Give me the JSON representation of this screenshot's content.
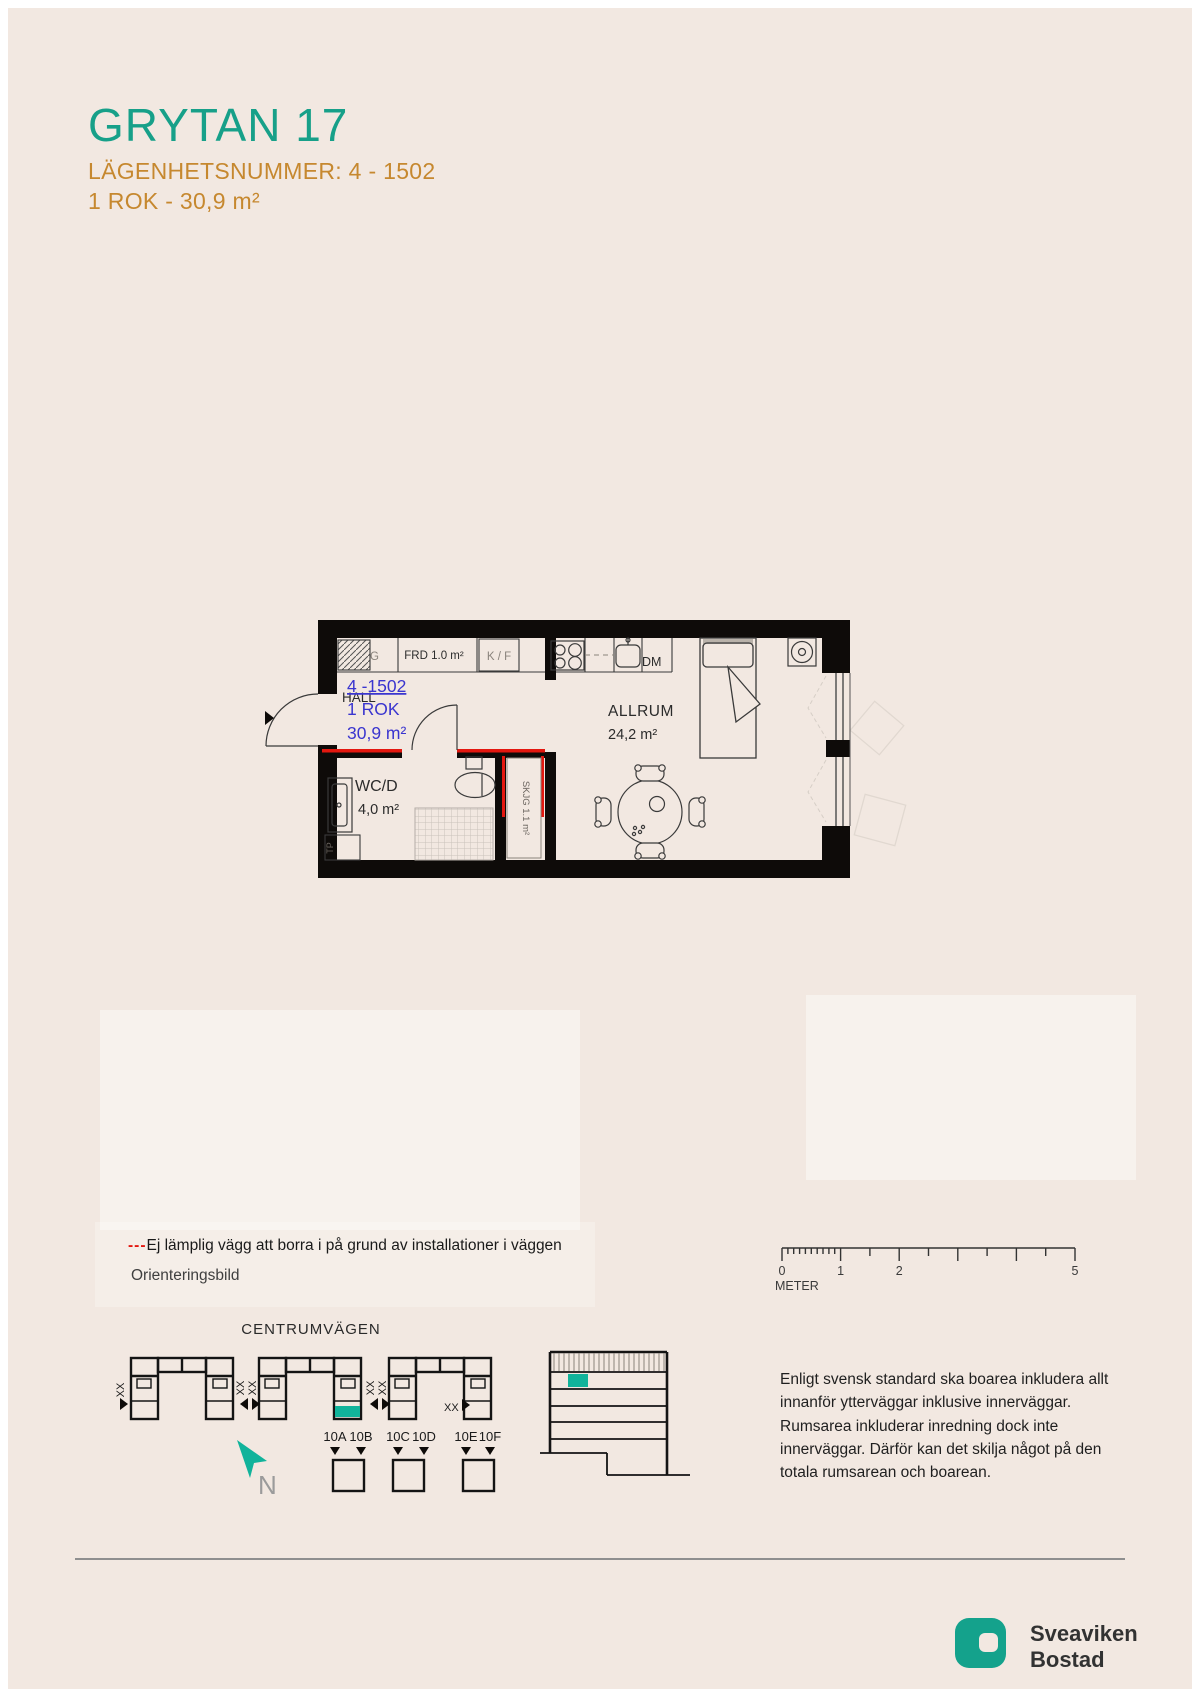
{
  "header": {
    "title": "GRYTAN 17",
    "apartment_number_line": "LÄGENHETSNUMMER: 4 - 1502",
    "size_line": "1 ROK - 30,9 m²"
  },
  "floorplan": {
    "unit_number": "4 -1502",
    "unit_type": "1 ROK",
    "unit_area": "30,9 m²",
    "hall_label": "HALL",
    "allrum_label": "ALLRUM",
    "allrum_area": "24,2 m²",
    "wcd_label": "WC/D",
    "wcd_area": "4,0 m²",
    "frd_label": "FRD 1.0 m²",
    "kf_label": "K / F",
    "dm_label": "DM",
    "g_label": "G",
    "tp_label": "TP",
    "skjg_label": "SKJG 1.1 m²"
  },
  "legend": {
    "no_drill_dashes": "---",
    "no_drill_text": "Ej lämplig vägg att borra i på grund av installationer i väggen",
    "orientation_label": "Orienteringsbild"
  },
  "scale_bar": {
    "labels": [
      "0",
      "1",
      "2",
      "5"
    ],
    "unit_label": "METER"
  },
  "site_plan": {
    "street_name": "CENTRUMVÄGEN",
    "xx_label": "XX",
    "north_label": "N",
    "entrance_labels": [
      "10A",
      "10B",
      "10C",
      "10D",
      "10E",
      "10F"
    ]
  },
  "info": {
    "text": "Enligt svensk standard ska boarea inkludera allt innanför ytterväggar inklusive innerväggar. Rumsarea inkluderar inredning dock inte innerväggar. Därför kan det skilja något på den totala rumsarean och boarean."
  },
  "logo": {
    "name_line1": "Sveaviken",
    "name_line2": "Bostad"
  },
  "colors": {
    "teal": "#17a089",
    "orange": "#c6882f",
    "plan_blue": "#3a35cf",
    "no_drill_red": "#e3170f",
    "wall_black": "#0e0b09",
    "background": "#f2e8e1"
  }
}
